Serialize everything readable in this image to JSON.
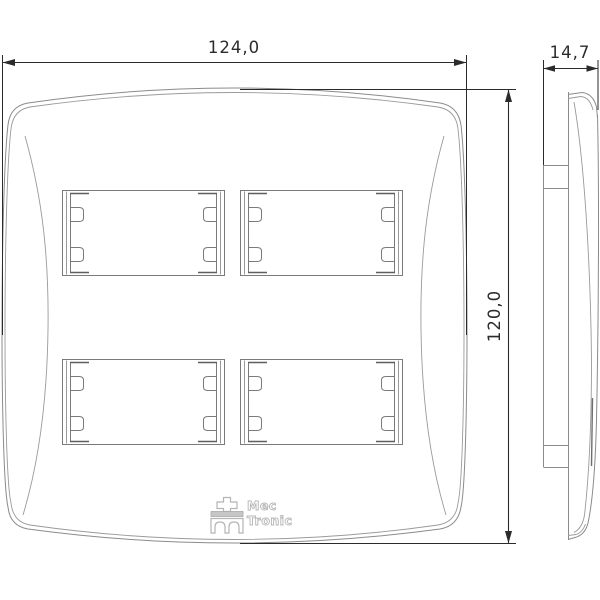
{
  "page": {
    "type": "technical-drawing",
    "subject": "4-module wall faceplate, front and side orthographic views",
    "background": "#ffffff"
  },
  "dimensions": {
    "width": {
      "label": "124,0",
      "unit": "mm",
      "applies_to": "front view overall width"
    },
    "height": {
      "label": "120,0",
      "unit": "mm",
      "applies_to": "front view overall height"
    },
    "depth": {
      "label": "14,7",
      "unit": "mm",
      "applies_to": "side view overall depth"
    }
  },
  "logo": {
    "line1": "Mec",
    "line2": "Tronic"
  },
  "views": {
    "front": {
      "module_windows": 4,
      "window_layout": "2 x 2 grid",
      "tabs_per_window_side": 2
    },
    "side": {
      "description": "profile with rear mounting chassis"
    }
  },
  "colors": {
    "dimension_lines": "#2b2b2b",
    "drawing_lines": "#8b8b8b",
    "window_lines": "#7a7a7a",
    "window_lip_marks": "#5f5f5f",
    "logo_outline": "#b5b5b5"
  }
}
